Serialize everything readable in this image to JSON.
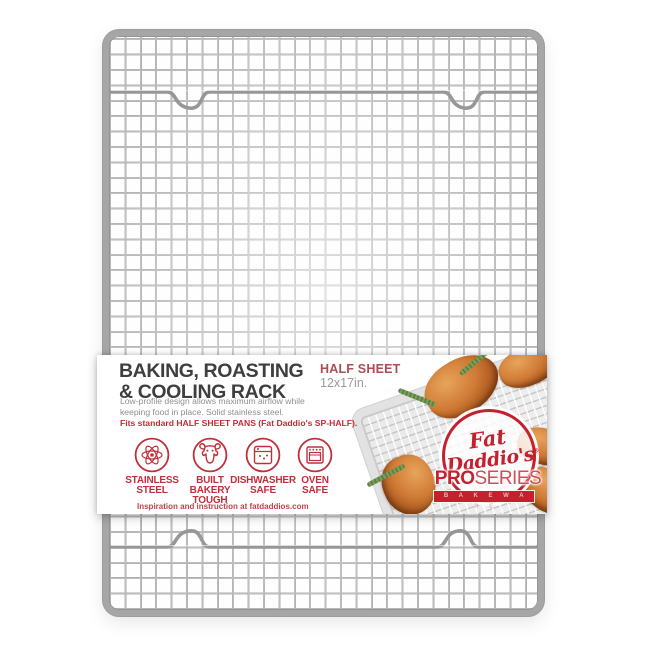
{
  "product": {
    "title_line1": "BAKING, ROASTING",
    "title_line2": "& COOLING RACK",
    "size_name": "HALF SHEET",
    "size_dims": "12x17in.",
    "description": "Low-profile design allows maximum airflow while\nkeeping food in place. Solid stainless steel.",
    "fits_note": "Fits standard HALF SHEET PANS (Fat Daddio's SP-HALF).",
    "footer": "Inspiration and instruction at fatdaddios.com",
    "features": [
      {
        "icon": "atom-icon",
        "label": "STAINLESS\nSTEEL"
      },
      {
        "icon": "bull-icon",
        "label": "BUILT\nBAKERY\nTOUGH"
      },
      {
        "icon": "dishwasher-icon",
        "label": "DISHWASHER\nSAFE"
      },
      {
        "icon": "oven-icon",
        "label": "OVEN\nSAFE"
      }
    ]
  },
  "brand": {
    "name_line1": "Fat",
    "name_line2": "Daddio's",
    "registered": "®",
    "series_bold": "PRO",
    "series_light": "SERIES",
    "bakeware": "B A K E W A R E"
  },
  "colors": {
    "brand_red": "#c4202e",
    "feature_red": "#c0303c",
    "muted_red": "#a94e55",
    "title_dark": "#3e3e3e",
    "text_gray": "#8f8f8f",
    "metal_gray": "#a6a6a6"
  }
}
